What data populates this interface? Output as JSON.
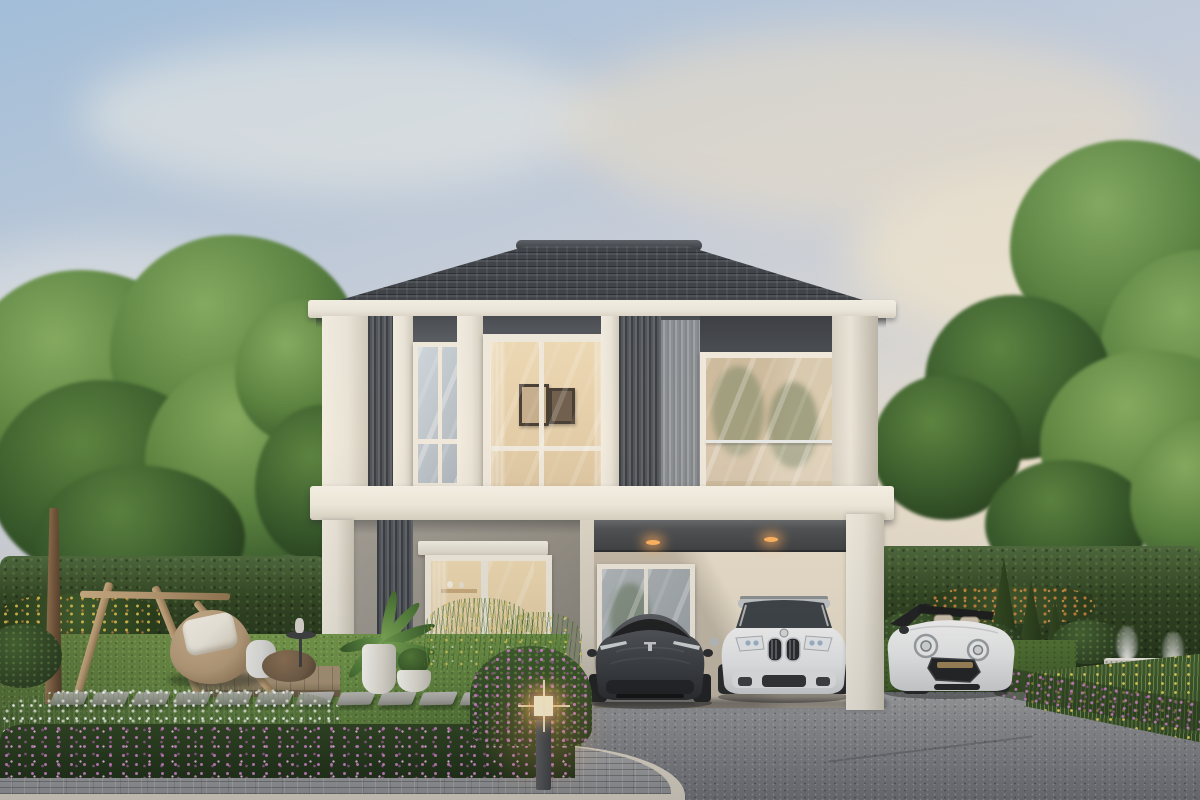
{
  "scene": {
    "type": "architectural-exterior-render",
    "time_of_day": "dusk",
    "description": "Photorealistic render of a modern two-storey house with white frame facade, dark grey panels and vertical louvres, hip tile roof, a carport with two recessed downlights sheltering two SUVs, a white convertible mini parked beside, and a landscaped dusk garden with hedges, young supported tree, beanbag lounge corner, stepping stones, flower beds and a lit bollard lamp"
  },
  "canvas": {
    "width": 1200,
    "height": 800
  },
  "palette": {
    "sky_top": "#a3bfda",
    "sky_mid": "#c6cedb",
    "sky_low": "#e8dfd0",
    "cloud": "#f2efe7",
    "cloud_warm": "#ecdfc8",
    "foliage_light": "#7fa85c",
    "foliage_mid": "#55803c",
    "foliage_dark": "#2f5526",
    "foliage_deep": "#1f3a19",
    "hedge": "#2c421f",
    "hedge_light": "#49663a",
    "lawn": "#6b9245",
    "lawn_dark": "#42632c",
    "roof": "#383d43",
    "roof_dark": "#23272c",
    "fascia": "#ece8dd",
    "facade_white": "#e9e5da",
    "panel_dark": "#5b6168",
    "panel_deep": "#41464d",
    "louver_dark": "#4b5057",
    "louver_light": "#9ba0a5",
    "wall_gray": "#928e86",
    "wall_lit": "#d3cdc0",
    "interior_warm": "#dcc6a2",
    "interior_lit": "#ecd9b4",
    "glass_cool": "#cdd6dd",
    "glass_dark": "#aab4bc",
    "slab": "#efecdf",
    "asphalt": "#8e9093",
    "asphalt_dark": "#6e7074",
    "concrete": "#a3a5a7",
    "paver": "#9fa0a2",
    "curb": "#d5cec0",
    "stone": "#a8a8a4",
    "deck_wood": "#a2906f",
    "trunk": "#8a6b4a",
    "wood": "#b89a72",
    "flower_pink": "#c77fc0",
    "flower_white": "#f2f2ee",
    "flower_yellow": "#d9c44a",
    "flower_orange": "#c8803a",
    "beanbag": "#b59b79",
    "pillow": "#f0ece2",
    "pouf": "#dfe0de",
    "ottoman": "#6f5b45",
    "car_dark": "#3e4247",
    "car_dark2": "#2a2d31",
    "car_white": "#eef0f1",
    "glow": "#ffcf8a",
    "light_warm": "#ffb45e"
  },
  "objects": {
    "house": {
      "storeys": 2,
      "roof": "hip roof, dark grey tiles with ridge cap",
      "facade": [
        "white frame pillars",
        "dark grey recessed panels",
        "vertical louvre screens"
      ],
      "upper_windows": [
        "narrow left window",
        "centre window with two framed pictures inside",
        "right window with glass balustrade"
      ],
      "lower_level": [
        "sliding glass door to living room",
        "carport with 2 warm downlights",
        "window behind carport"
      ],
      "slab_band": "white floor band between storeys"
    },
    "vehicles": [
      {
        "type": "suv",
        "color": "dark-grey",
        "position": "carport-left"
      },
      {
        "type": "suv",
        "color": "white",
        "position": "carport-right"
      },
      {
        "type": "convertible-mini",
        "color": "white",
        "position": "right-of-carport",
        "top": "down"
      }
    ],
    "garden": {
      "young_tree_with_wooden_support": true,
      "beanbag_chair_with_pillow": true,
      "pouf": true,
      "ottoman": true,
      "side_table": true,
      "wood_deck": true,
      "stepping_stones": 12,
      "bollard_light_on": 1,
      "flower_colors": [
        "white",
        "pink",
        "yellow",
        "orange",
        "purple"
      ],
      "hedge_walls": true,
      "potted_plants": 2,
      "stone_fountain_jets": 2,
      "paver_walkway_with_curb": true,
      "asphalt_driveway": true
    },
    "sky": {
      "clouds": "soft warm dusk clouds"
    }
  }
}
